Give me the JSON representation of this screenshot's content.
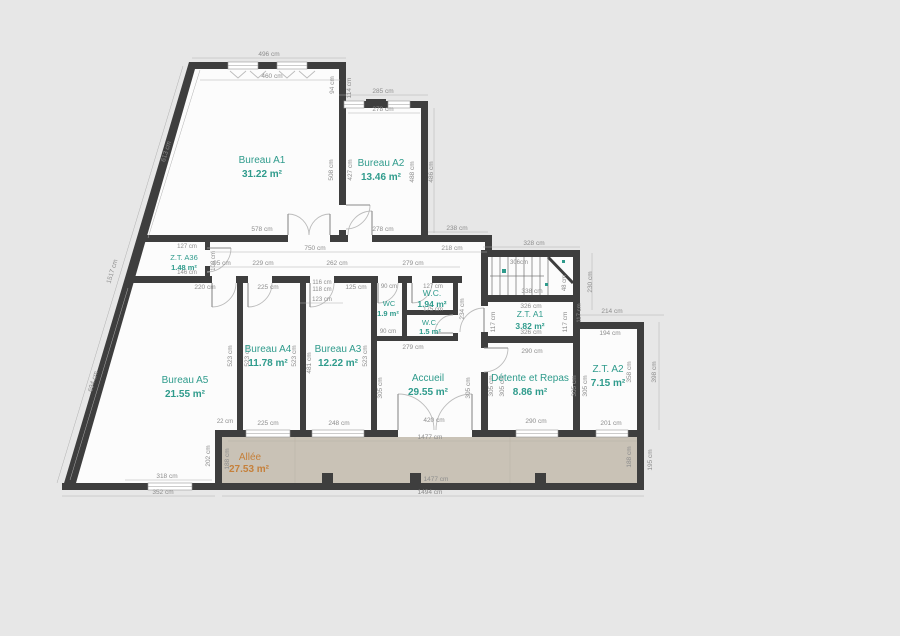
{
  "colors": {
    "background": "#e7e7e7",
    "floor": "#fcfcfc",
    "wall": "#3e3e3e",
    "allee_fill": "#c9c2b6",
    "room_label": "#2f9b8c",
    "allee_label": "#c5803b",
    "dimension_text": "#8d8d8d"
  },
  "plan": {
    "rooms": [
      {
        "name": "Bureau A1",
        "area": "31.22 m²"
      },
      {
        "name": "Bureau A2",
        "area": "13.46 m²"
      },
      {
        "name": "Z.T. A36",
        "area": "1.48 m²"
      },
      {
        "name": "Bureau A4",
        "area": "11.78 m²"
      },
      {
        "name": "Bureau A3",
        "area": "12.22 m²"
      },
      {
        "name": "Bureau A5",
        "area": "21.55 m²"
      },
      {
        "name": "W.C.",
        "area": "1.94 m²"
      },
      {
        "name": "W.C.",
        "area": "1.5 m²"
      },
      {
        "name": "WC",
        "area": "1.9 m²"
      },
      {
        "name": "Accueil",
        "area": "29.55 m²"
      },
      {
        "name": "Z.T. A1",
        "area": "3.82 m²"
      },
      {
        "name": "Détente et Repas",
        "area": "8.86 m²"
      },
      {
        "name": "Z.T. A2",
        "area": "7.15 m²"
      },
      {
        "name": "Allée",
        "area": "27.53 m²"
      }
    ],
    "dims": [
      "496 cm",
      "460 cm",
      "94 cm",
      "114 cm",
      "285 cm",
      "278 cm",
      "613 cm",
      "1517 cm",
      "508 cm",
      "427 cm",
      "488 cm",
      "486 cm",
      "578 cm",
      "278 cm",
      "238 cm",
      "218 cm",
      "328 cm",
      "750 cm",
      "230 cm",
      "127 cm",
      "108 cm",
      "146 cm",
      "95 cm",
      "229 cm",
      "262 cm",
      "279 cm",
      "220 cm",
      "225 cm",
      "116 cm",
      "118 cm",
      "125 cm",
      "90 cm",
      "127 cm",
      "123 cm",
      "306cm",
      "338 cm",
      "48 cm",
      "175 cm",
      "90 cm",
      "279 cm",
      "234 cm",
      "117 cm",
      "117 cm",
      "326 cm",
      "326 cm",
      "290 cm",
      "290 cm",
      "523 cm",
      "523 cm",
      "523 cm",
      "481 cm",
      "523 cm",
      "305 cm",
      "305 cm",
      "305 cm",
      "305 cm",
      "305 cm",
      "305 cm",
      "694 cm",
      "214 cm",
      "194 cm",
      "117 cm",
      "358 cm",
      "398 cm",
      "201 cm",
      "22 cm",
      "225 cm",
      "248 cm",
      "420 cm",
      "318 cm",
      "352 cm",
      "202 cm",
      "188 cm",
      "1477 cm",
      "1477 cm",
      "188 cm",
      "195 cm",
      "1494 cm"
    ]
  }
}
